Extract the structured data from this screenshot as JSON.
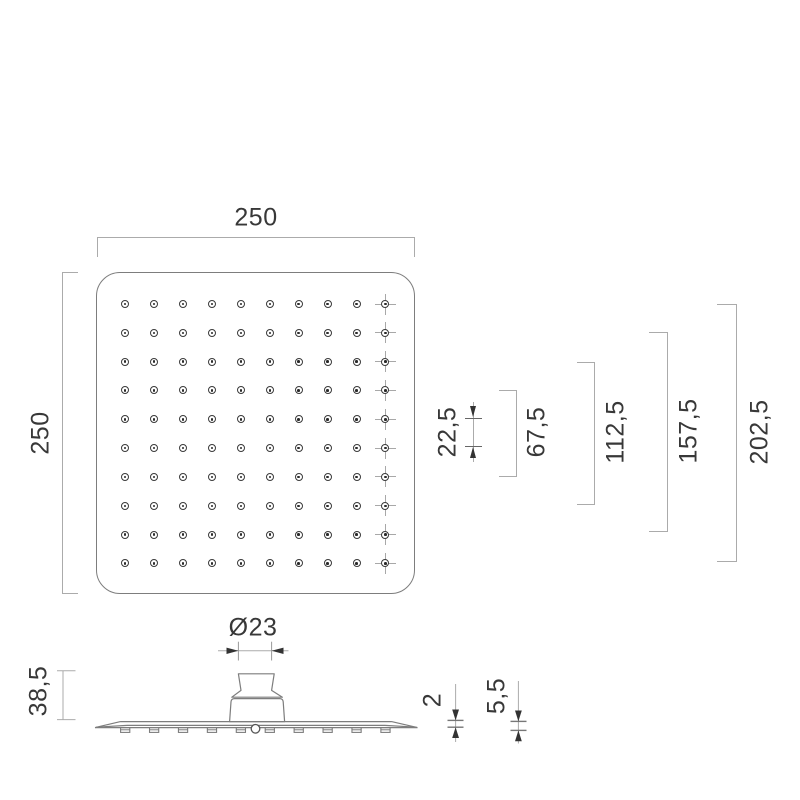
{
  "dimensions": {
    "plate_width": "250",
    "plate_height": "250",
    "nozzle_span_1": "22,5",
    "nozzle_span_3": "67,5",
    "nozzle_span_5": "112,5",
    "nozzle_span_7": "157,5",
    "nozzle_span_9": "202,5",
    "connector_diameter": "Ø23",
    "overall_height": "38,5",
    "plate_thickness": "2",
    "rim_height": "5,5"
  },
  "top_view": {
    "nozzle_grid": {
      "rows": 10,
      "cols": 10,
      "crosshair_column": 10
    }
  },
  "side_view": {
    "nub_count": 10
  },
  "colors": {
    "background": "#ffffff",
    "outline": "#7d7d7d",
    "dim_line": "#ababab",
    "arrow": "#333333",
    "text": "#383838"
  }
}
